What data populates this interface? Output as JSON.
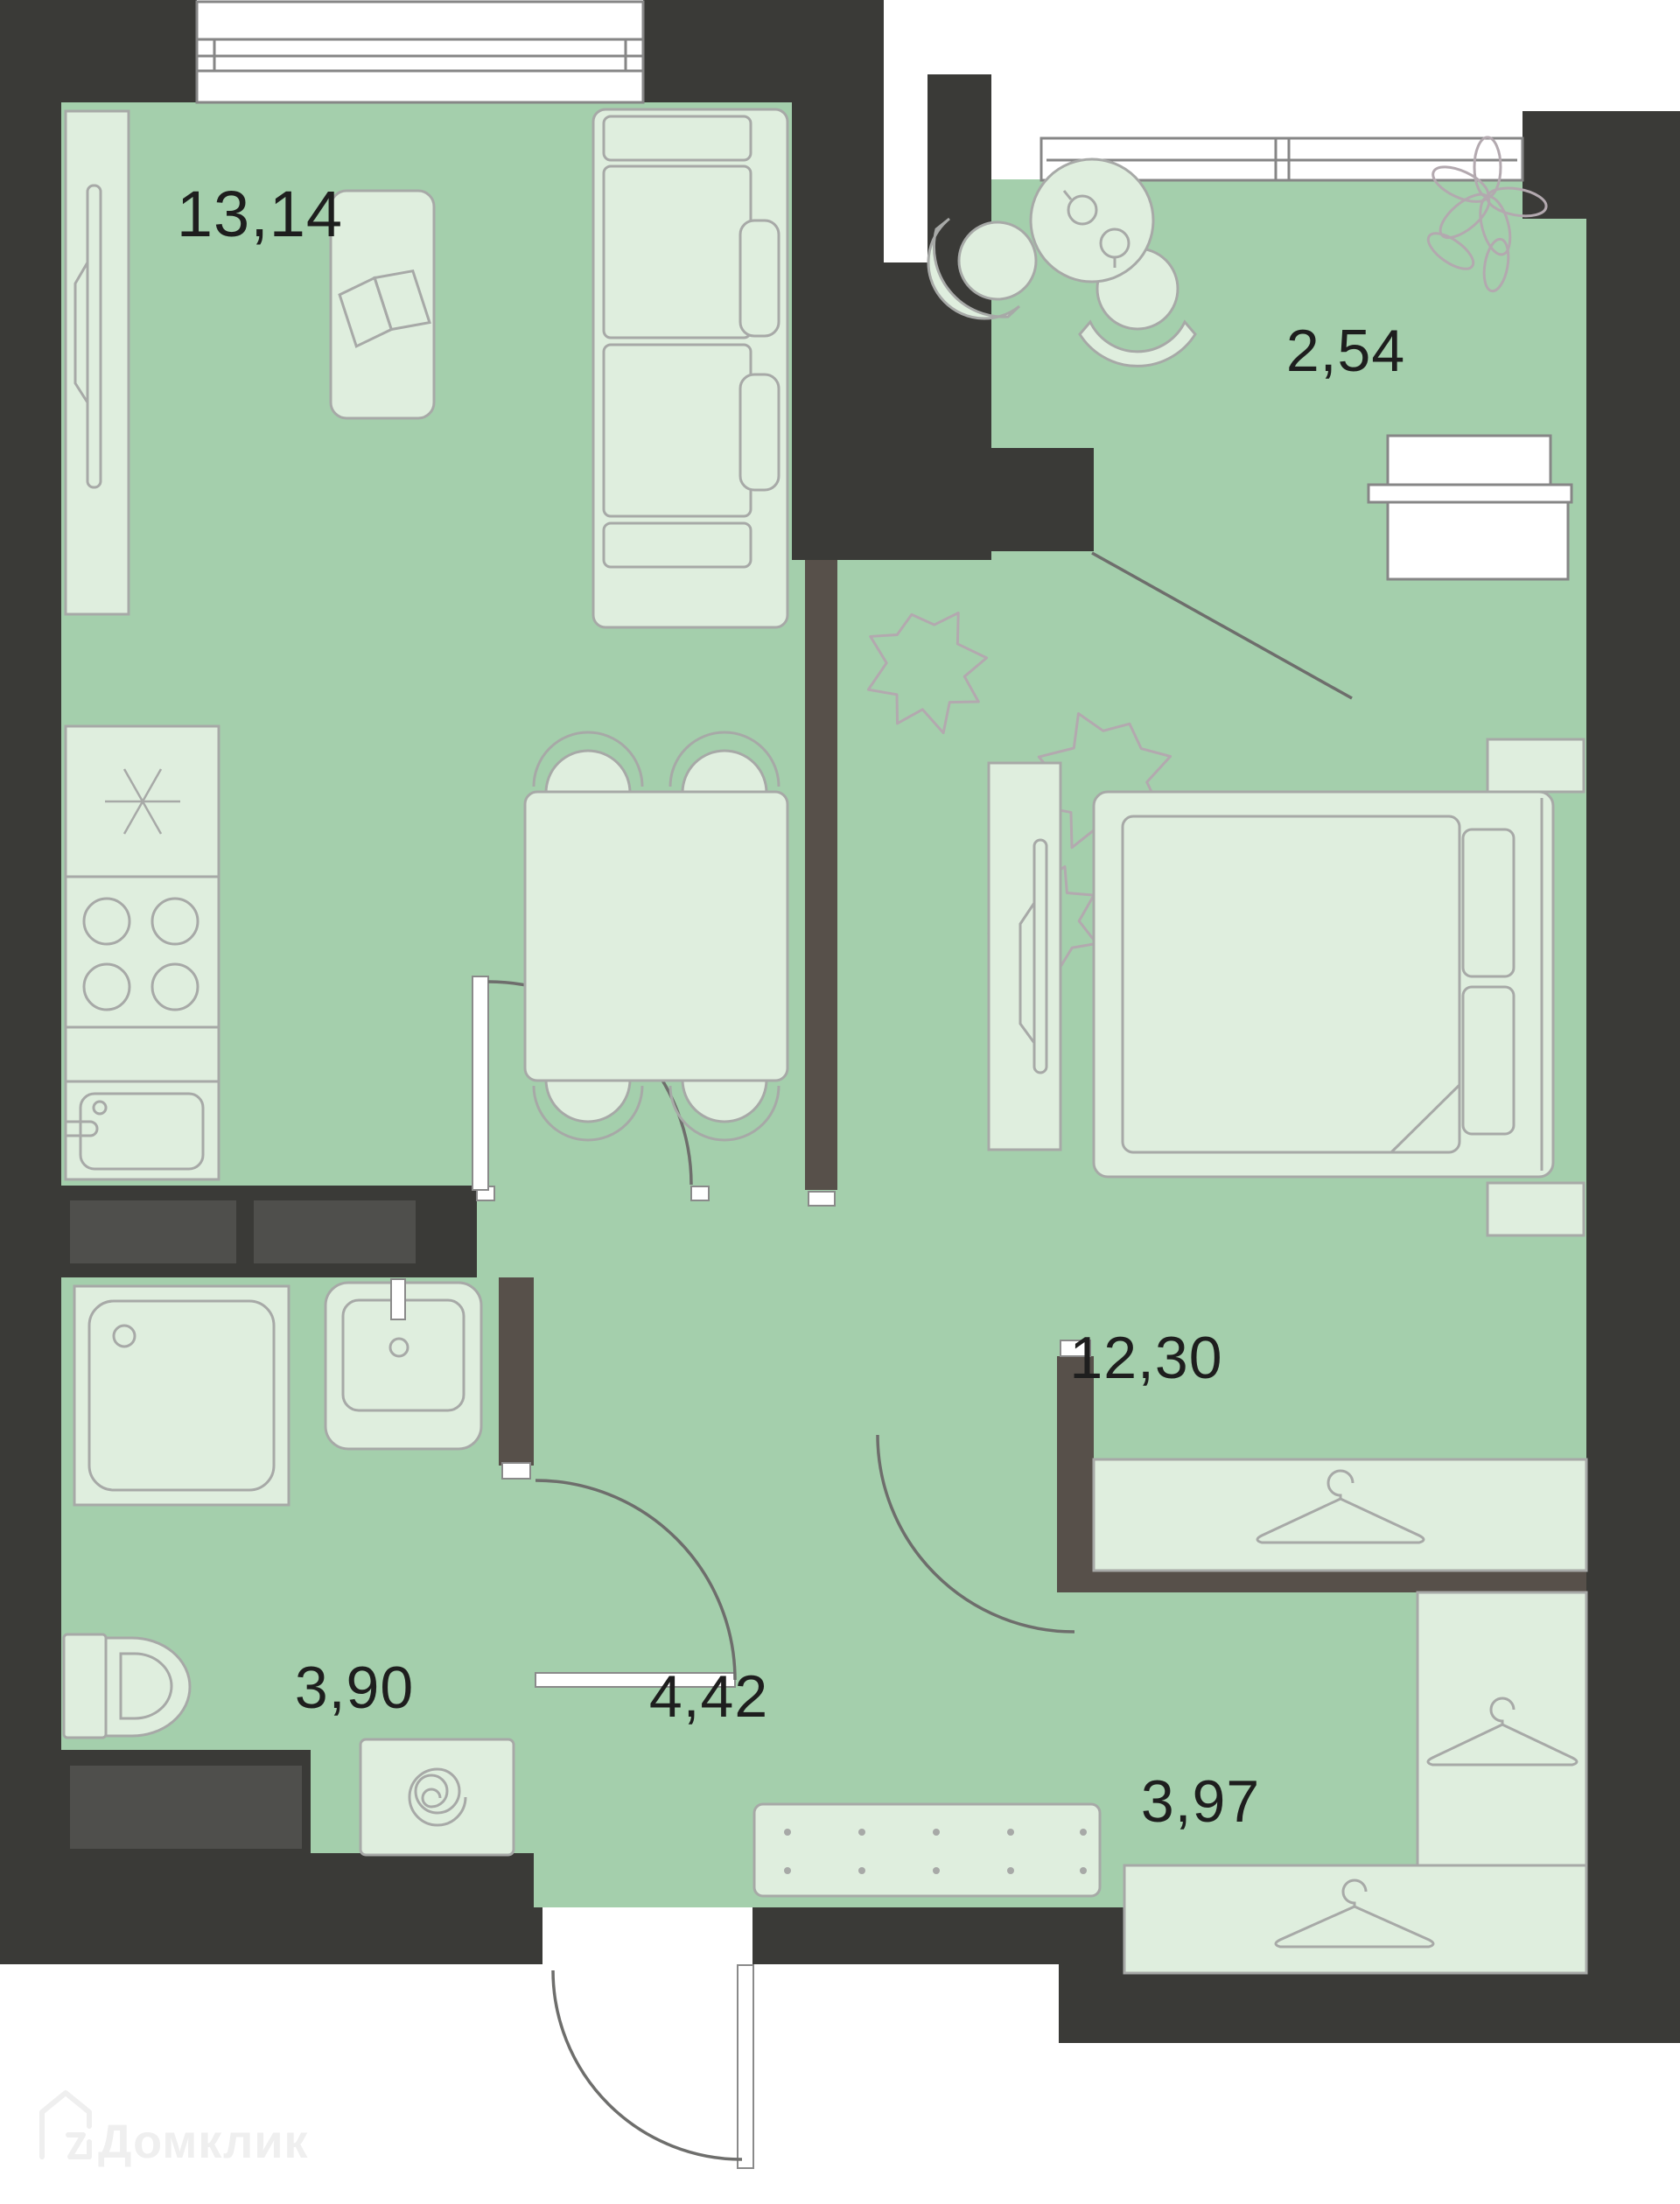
{
  "plan": {
    "type": "apartment-floor-plan",
    "rooms": {
      "living_kitchen": {
        "area_label": "13,14"
      },
      "balcony": {
        "area_label": "2,54"
      },
      "bedroom": {
        "area_label": "12,30"
      },
      "bathroom": {
        "area_label": "3,90"
      },
      "hallway": {
        "area_label": "4,42"
      },
      "wardrobe_room": {
        "area_label": "3,97"
      }
    },
    "watermark": {
      "text": "Домклик"
    },
    "colors": {
      "wall_dark": "#3a3a37",
      "partition_brown": "#57504a",
      "duct_gray": "#4f4f4c",
      "floor_green": "#a4cfac",
      "furniture_light": "#dfeede",
      "furniture_stroke": "#a7a9a7",
      "label_text": "#1e1e1e",
      "watermark_gray": "#efefef"
    }
  }
}
